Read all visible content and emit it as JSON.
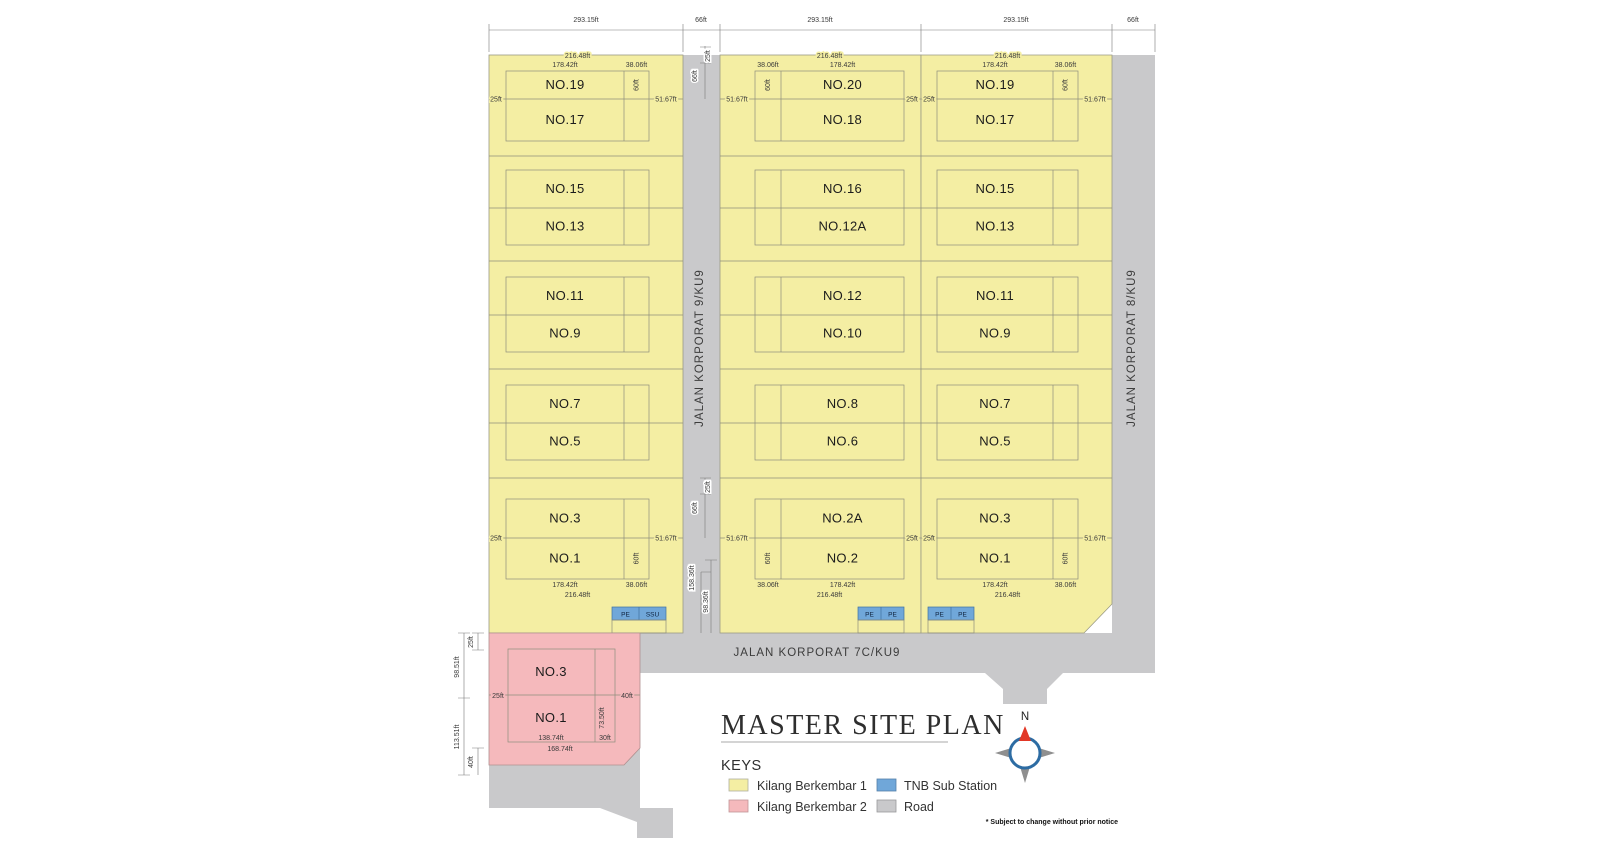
{
  "document": {
    "title": "MASTER SITE PLAN",
    "keys_heading": "KEYS",
    "footnote": "* Subject to change without prior notice",
    "north_label": "N"
  },
  "legend": [
    {
      "label": "Kilang Berkembar 1",
      "swatch": "kilang1"
    },
    {
      "label": "Kilang Berkembar 2",
      "swatch": "kilang2"
    },
    {
      "label": "TNB Sub Station",
      "swatch": "tnb"
    },
    {
      "label": "Road",
      "swatch": "road"
    }
  ],
  "roads": {
    "left_vertical": "JALAN KORPORAT 9/KU9",
    "right_vertical": "JALAN KORPORAT 8/KU9",
    "bottom_horizontal": "JALAN KORPORAT 7C/KU9"
  },
  "top_dimensions": [
    "293.15ft",
    "66ft",
    "293.15ft",
    "293.15ft",
    "66ft"
  ],
  "road_dims": {
    "top": [
      "25ft",
      "66ft"
    ],
    "middle": [
      "25ft",
      "66ft"
    ],
    "lower": [
      "158.36ft",
      "98.36ft"
    ]
  },
  "columns": [
    {
      "name": "left-block",
      "plots": [
        [
          "NO.19",
          "NO.17"
        ],
        [
          "NO.15",
          "NO.13"
        ],
        [
          "NO.11",
          "NO.9"
        ],
        [
          "NO.7",
          "NO.5"
        ],
        [
          "NO.3",
          "NO.1"
        ]
      ],
      "dims": {
        "outer": "216.48ft",
        "main": "178.42ft",
        "strip": "38.06ft",
        "depth": "60ft",
        "near_side": "25ft",
        "far_side": "51.67ft"
      }
    },
    {
      "name": "middle-block",
      "plots": [
        [
          "NO.20",
          "NO.18"
        ],
        [
          "NO.16",
          "NO.12A"
        ],
        [
          "NO.12",
          "NO.10"
        ],
        [
          "NO.8",
          "NO.6"
        ],
        [
          "NO.2A",
          "NO.2"
        ]
      ],
      "dims": {
        "outer": "216.48ft",
        "main": "178.42ft",
        "strip": "38.06ft",
        "depth": "60ft",
        "near_side": "25ft",
        "far_side": "51.67ft"
      }
    },
    {
      "name": "right-block",
      "plots": [
        [
          "NO.19",
          "NO.17"
        ],
        [
          "NO.15",
          "NO.13"
        ],
        [
          "NO.11",
          "NO.9"
        ],
        [
          "NO.7",
          "NO.5"
        ],
        [
          "NO.3",
          "NO.1"
        ]
      ],
      "dims": {
        "outer": "216.48ft",
        "main": "178.42ft",
        "strip": "38.06ft",
        "depth": "60ft",
        "near_side": "25ft",
        "far_side": "51.67ft"
      }
    }
  ],
  "tnb_stations": [
    [
      "PE",
      "SSU"
    ],
    [
      "PE",
      "PE"
    ],
    [
      "PE",
      "PE"
    ]
  ],
  "pink_block": {
    "plots": [
      "NO.3",
      "NO.1"
    ],
    "dims": {
      "outer_left_top": "25ft",
      "outer_left_upper": "98.51ft",
      "outer_left_lower": "113.51ft",
      "outer_left_bottom": "40ft",
      "inner_left": "25ft",
      "inner_right": "40ft",
      "inner_depth": "73.50ft",
      "bottom_main": "138.74ft",
      "bottom_strip": "30ft",
      "bottom_outer": "168.74ft"
    }
  },
  "colors": {
    "kilang1": "#f4eea3",
    "kilang2": "#f5b9bc",
    "tnb": "#70a7d9",
    "road": "#c9c9cb",
    "outline": "#8e8e7c",
    "compass_ring": "#2d6ca3",
    "compass_needle": "#e23726",
    "compass_point": "#8f8f8f",
    "text": "#1b1b1b"
  }
}
